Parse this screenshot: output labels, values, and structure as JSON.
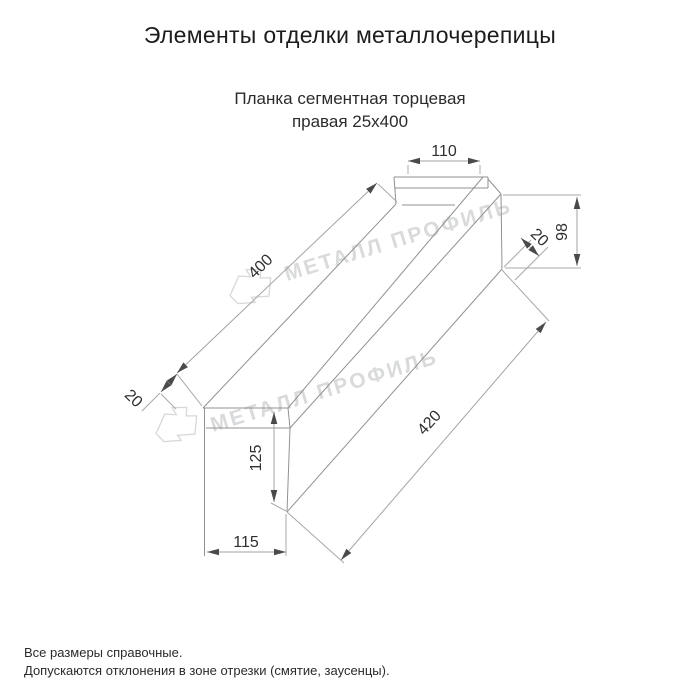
{
  "header": {
    "title": "Элементы отделки металлочерепицы"
  },
  "product": {
    "name_line1": "Планка сегментная торцевая",
    "name_line2": "правая 25х400"
  },
  "drawing": {
    "type": "technical-dimension-drawing",
    "dimensions": {
      "top_flange_width": "110",
      "end_height": "98",
      "end_hem": "20",
      "top_length": "400",
      "left_hem": "20",
      "face_height": "125",
      "bottom_flange_width": "115",
      "bottom_length": "420"
    },
    "watermark_text": "МЕТАЛЛ ПРОФИЛЬ",
    "colors": {
      "outline": "#919191",
      "dimension_line": "#a3a3a3",
      "arrow": "#4a4a4a",
      "label": "#2f2f2f",
      "watermark": "#d9dadb",
      "background": "#ffffff"
    }
  },
  "footer": {
    "note1": "Все размеры справочные.",
    "note2": "Допускаются отклонения в зоне отрезки (смятие, заусенцы)."
  }
}
